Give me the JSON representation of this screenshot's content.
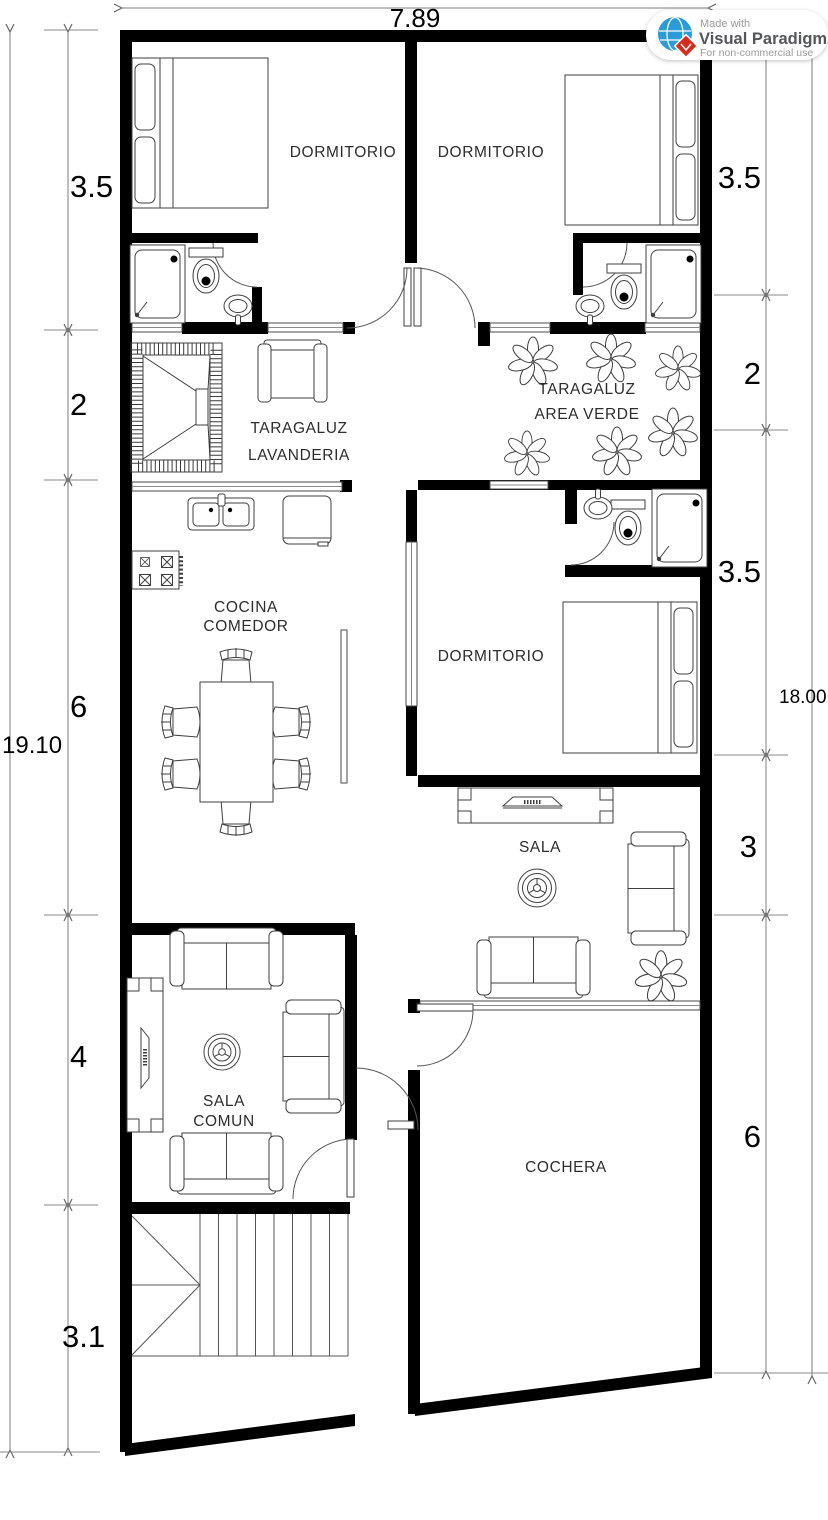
{
  "badge": {
    "made_with": "Made with",
    "brand": "Visual Paradigm",
    "license": "For non-commercial use"
  },
  "dimensions": {
    "top_width": "7.89",
    "left_total": "19.10",
    "right_total": "18.00",
    "left_segments": [
      "3.5",
      "2",
      "6",
      "4",
      "3.1"
    ],
    "right_segments": [
      "3.5",
      "2",
      "3.5",
      "3",
      "6"
    ]
  },
  "rooms": {
    "bedroom_top_left": "DORMITORIO",
    "bedroom_top_right": "DORMITORIO",
    "laundry_line1": "TARAGALUZ",
    "laundry_line2": "LAVANDERIA",
    "green_line1": "TARAGALUZ",
    "green_line2": "AREA VERDE",
    "kitchen_line1": "COCINA",
    "kitchen_line2": "COMEDOR",
    "bedroom_right": "DORMITORIO",
    "living": "SALA",
    "common_line1": "SALA",
    "common_line2": "COMUN",
    "garage": "COCHERA"
  },
  "colors": {
    "wall": "#000000",
    "furniture_stroke": "#3f3f3f",
    "dimension_line": "#7e7e7e",
    "badge_blue": "#2a9cd6",
    "badge_red": "#d92b1c",
    "badge_text": "#55565a"
  }
}
